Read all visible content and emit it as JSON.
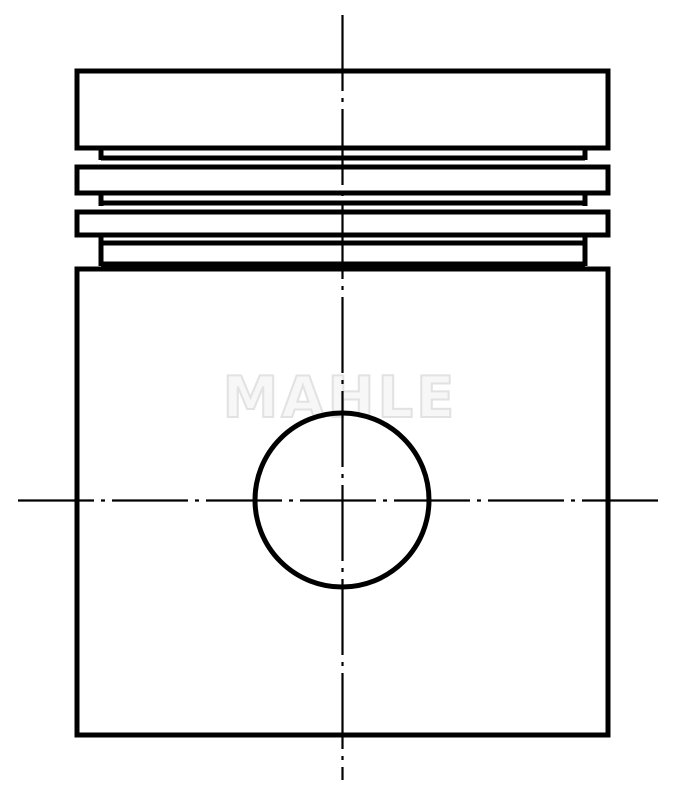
{
  "watermark": {
    "text": "MAHLE",
    "color": "#e2e2e2"
  },
  "drawing": {
    "canvas": {
      "width": 680,
      "height": 800,
      "background": "#ffffff"
    },
    "stroke_color": "#000000",
    "outline_stroke_width": 5,
    "centerline_stroke_width": 2.2,
    "centerline_dash": "76 7 4 7",
    "shapes": [
      {
        "type": "rect",
        "name": "piston-crown",
        "x": 77,
        "y": 71,
        "w": 531,
        "h": 77
      },
      {
        "type": "rect",
        "name": "ring-land-1",
        "x": 77,
        "y": 167,
        "w": 531,
        "h": 26
      },
      {
        "type": "rect",
        "name": "ring-land-2",
        "x": 77,
        "y": 212,
        "w": 531,
        "h": 23
      },
      {
        "type": "rect",
        "name": "piston-skirt-body",
        "x": 77,
        "y": 269,
        "w": 531,
        "h": 466
      },
      {
        "type": "line",
        "name": "groove-root-line-1",
        "x1": 101,
        "y1": 158,
        "x2": 585,
        "y2": 158
      },
      {
        "type": "line",
        "name": "groove-root-line-2",
        "x1": 101,
        "y1": 203,
        "x2": 585,
        "y2": 203
      },
      {
        "type": "line",
        "name": "groove-root-line-3",
        "x1": 101,
        "y1": 243,
        "x2": 585,
        "y2": 243
      },
      {
        "type": "line",
        "name": "groove-lower-shoulder",
        "x1": 101,
        "y1": 264,
        "x2": 585,
        "y2": 264
      },
      {
        "type": "line",
        "name": "groove-1-left-wall",
        "x1": 101,
        "y1": 146,
        "x2": 101,
        "y2": 160
      },
      {
        "type": "line",
        "name": "groove-1-right-wall",
        "x1": 585,
        "y1": 146,
        "x2": 585,
        "y2": 160
      },
      {
        "type": "line",
        "name": "groove-2-left-wall",
        "x1": 101,
        "y1": 191,
        "x2": 101,
        "y2": 206
      },
      {
        "type": "line",
        "name": "groove-2-right-wall",
        "x1": 585,
        "y1": 191,
        "x2": 585,
        "y2": 206
      },
      {
        "type": "line",
        "name": "groove-3-left-wall",
        "x1": 101,
        "y1": 233,
        "x2": 101,
        "y2": 266
      },
      {
        "type": "line",
        "name": "groove-3-right-wall",
        "x1": 585,
        "y1": 233,
        "x2": 585,
        "y2": 266
      },
      {
        "type": "circle",
        "name": "pin-bore",
        "cx": 342,
        "cy": 500,
        "r": 87
      }
    ],
    "centerlines": [
      {
        "type": "line",
        "name": "vertical-centerline",
        "x1": 342.5,
        "y1": 15,
        "x2": 342.5,
        "y2": 780
      },
      {
        "type": "line",
        "name": "horizontal-centerline",
        "x1": 18,
        "y1": 500.5,
        "x2": 665,
        "y2": 500.5
      }
    ]
  }
}
